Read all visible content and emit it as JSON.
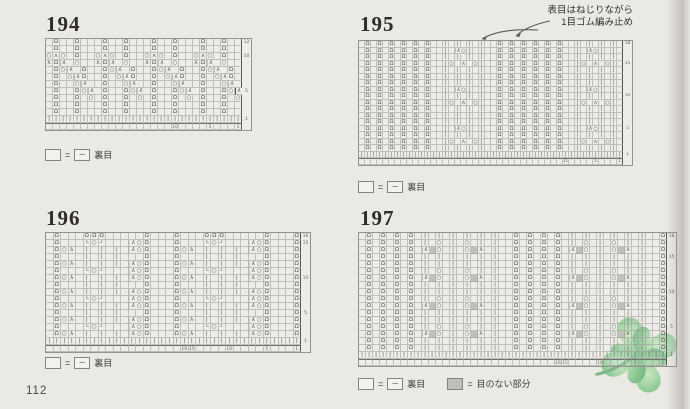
{
  "page": {
    "number": "112"
  },
  "colors": {
    "page_bg": "#ebe9e4",
    "grid_line": "#95938e",
    "symbol_color": "#524f4b",
    "no_stitch_fill": "#c2c0ba",
    "clover_green": "#7cbd88"
  },
  "legend": {
    "eq": "=",
    "purl_dash": "─",
    "purl_label": "裏目",
    "no_stitch_label": "目のない部分"
  },
  "annotation195": {
    "line1": "表目はねじりながら",
    "line2": "1目ゴム編み止め"
  },
  "glyph_map": {
    ".": "",
    "Q": "Ω",
    "o": "○",
    "A": "λ",
    "L": "λ",
    "Y": "ʌ",
    "|": "|",
    "#": "",
    "(": "└",
    ")": "┘"
  },
  "charts": [
    {
      "id": "194",
      "title": "194",
      "x": 45,
      "y": 38,
      "cols": 28,
      "cell_w": 7,
      "cell_h": 7,
      "font": 5.5,
      "title_x": 46,
      "title_y": 12,
      "rows": [
        ".Q..Q...Q..Q...Q..Q...Q..Q..",
        ".Q..Q...Q..Q...Q..Q...Q..Q..",
        "oYo.Q..oYo.Q..oYo.Q..oYo.Q..",
        "LQA.o..LQA.o..LQA.o..LQA.o..",
        ".QoA.Q..QoA.Q..QoA.Q..QoA.Q.",
        ".Q.oAQ..Q.oAQ..Q.oAQ..Q.oAQ.",
        ".Q..oA..Q..oA..Q..oA..Q..oA.",
        ".Q..QoA.Q..QoA.Q..QoA.Q..QoA",
        ".Q..Q.o.Q..Q.o.Q..Q.o.Q..Q.o",
        ".Q..Q...Q..Q...Q..Q...Q..Q..",
        ".Q..Q...Q..Q...Q..Q...Q..Q.."
      ],
      "row_marks": [
        "1",
        "5",
        "10",
        "12"
      ],
      "col_marks": [
        "1",
        "5",
        "10"
      ]
    },
    {
      "id": "195",
      "title": "195",
      "x": 358,
      "y": 40,
      "cols": 44,
      "cell_w": 6,
      "cell_h": 6.5,
      "font": 5,
      "title_x": 360,
      "title_y": 12,
      "rows": [
        ".Q.Q.Q.Q.Q.Q..|.|.|.|..Q.Q.Q.Q.Q.Q..|.|.|.|.",
        ".Q.Q.Q.Q.Q.Q..|.Ao|.|..Q.Q.Q.Q.Q.Q..|.Ao|.|.",
        ".Q.Q.Q.Q.Q.Q..|.|.|.|..Q.Q.Q.Q.Q.Q..|.|.|.|.",
        ".Q.Q.Q.Q.Q.Q..|o.Y.o|..Q.Q.Q.Q.Q.Q..|o.Y.o|.",
        ".Q.Q.Q.Q.Q.Q..|.|.|.|..Q.Q.Q.Q.Q.Q..|.|.|.|.",
        ".Q.Q.Q.Q.Q.Q..|.|.|.|..Q.Q.Q.Q.Q.Q..|.|.|.|.",
        ".Q.Q.Q.Q.Q.Q..|.|.|.|..Q.Q.Q.Q.Q.Q..|.|.|.|.",
        ".Q.Q.Q.Q.Q.Q..|.Ao|.|..Q.Q.Q.Q.Q.Q..|.Ao|.|.",
        ".Q.Q.Q.Q.Q.Q..|.|.|.|..Q.Q.Q.Q.Q.Q..|.|.|.|.",
        ".Q.Q.Q.Q.Q.Q..|o.Y.o|..Q.Q.Q.Q.Q.Q..|o.Y.o|.",
        ".Q.Q.Q.Q.Q.Q..|.|.|.|..Q.Q.Q.Q.Q.Q..|.|.|.|.",
        ".Q.Q.Q.Q.Q.Q..|.|.|.|..Q.Q.Q.Q.Q.Q..|.|.|.|.",
        ".Q.Q.Q.Q.Q.Q..|.|.|.|..Q.Q.Q.Q.Q.Q..|.|.|.|.",
        ".Q.Q.Q.Q.Q.Q..|.Ao|.|..Q.Q.Q.Q.Q.Q..|.Ao|.|.",
        ".Q.Q.Q.Q.Q.Q..|.|.|.|..Q.Q.Q.Q.Q.Q..|.|.|.|.",
        ".Q.Q.Q.Q.Q.Q..|o.Y.o|..Q.Q.Q.Q.Q.Q..|o.Y.o|.",
        ".Q.Q.Q.Q.Q.Q..|.|.|.|..Q.Q.Q.Q.Q.Q..|.|.|.|."
      ],
      "row_marks": [
        "1",
        "5",
        "10",
        "15",
        "18"
      ],
      "col_marks": [
        "1",
        "5",
        "10"
      ]
    },
    {
      "id": "196",
      "title": "196",
      "x": 45,
      "y": 232,
      "cols": 34,
      "cell_w": 7.5,
      "cell_h": 7,
      "font": 5.5,
      "title_x": 46,
      "title_y": 206,
      "rows": [
        ".Q...QQQ.....Q...Q...QQQ.....Q...Q",
        ".Q...(o)...AoQ...Q...(o)...AoQ...Q",
        ".QoL.|.|.|.AoQ...QoL.|.|.|.AoQ...Q",
        ".Q...|.|.|...Q...Q...|.|.|...Q...Q",
        ".QoL.|.|.|.AoQ...QoL.|.|.|.AoQ...Q",
        ".Q...(o)...AoQ...Q...(o)...AoQ...Q",
        ".QoL.|.|.|.AoQ...QoL.|.|.|.AoQ...Q",
        ".Q...|.|.|...Q...Q...|.|.|...Q...Q",
        ".QoL.|.|.|.AoQ...QoL.|.|.|.AoQ...Q",
        ".Q...(o)...AoQ...Q...(o)...AoQ...Q",
        ".QoL.|.|.|.AoQ...QoL.|.|.|.AoQ...Q",
        ".Q...|.|.|...Q...Q...|.|.|...Q...Q",
        ".QoL.|.|.|.AoQ...QoL.|.|.|.AoQ...Q",
        ".Q...(o)...AoQ...Q...(o)...AoQ...Q",
        ".QoL.|.|.|.AoQ...QoL.|.|.|.AoQ...Q"
      ],
      "row_marks": [
        "1",
        "5",
        "10",
        "15",
        "16"
      ],
      "col_marks": [
        "1",
        "5",
        "10",
        "15",
        "16"
      ]
    },
    {
      "id": "197",
      "title": "197",
      "x": 358,
      "y": 232,
      "cols": 44,
      "cell_w": 7,
      "cell_h": 7,
      "font": 5.5,
      "title_x": 360,
      "title_y": 206,
      "rows": [
        ".Q.Q.Q.Q.|.|.|.|.|.|..Q.Q.Q.Q.|.|.|.|.|.|..Q",
        ".Q.Q.Q.Q.|.o.|.o.|.|..Q.Q.Q.Q.|.o.|.o.|.|..Q",
        ".Q.Q.Q.Q.A#o.|.o#L.|..Q.Q.Q.Q.A#o.|.o#L.|..Q",
        ".Q.Q.Q.Q.|.|.|.|.|.|..Q.Q.Q.Q.|.|.|.|.|.|..Q",
        ".Q.Q.Q.Q.|.|.|.|.|.|..Q.Q.Q.Q.|.|.|.|.|.|..Q",
        ".Q.Q.Q.Q.|.o.|.o.|.|..Q.Q.Q.Q.|.o.|.o.|.|..Q",
        ".Q.Q.Q.Q.A#o.|.o#L.|..Q.Q.Q.Q.A#o.|.o#L.|..Q",
        ".Q.Q.Q.Q.|.|.|.|.|.|..Q.Q.Q.Q.|.|.|.|.|.|..Q",
        ".Q.Q.Q.Q.|.|.|.|.|.|..Q.Q.Q.Q.|.|.|.|.|.|..Q",
        ".Q.Q.Q.Q.|.o.|.o.|.|..Q.Q.Q.Q.|.o.|.o.|.|..Q",
        ".Q.Q.Q.Q.A#o.|.o#L.|..Q.Q.Q.Q.A#o.|.o#L.|..Q",
        ".Q.Q.Q.Q.|.|.|.|.|.|..Q.Q.Q.Q.|.|.|.|.|.|..Q",
        ".Q.Q.Q.Q.|.|.|.|.|.|..Q.Q.Q.Q.|.|.|.|.|.|..Q",
        ".Q.Q.Q.Q.|.o.|.o.|.|..Q.Q.Q.Q.|.o.|.o.|.|..Q",
        ".Q.Q.Q.Q.A#o.|.o#L.|..Q.Q.Q.Q.A#o.|.o#L.|..Q",
        ".Q.Q.Q.Q.|.|.|.|.|.|..Q.Q.Q.Q.|.|.|.|.|.|..Q",
        ".Q.Q.Q.Q.|.|.|.|.|.|..Q.Q.Q.Q.|.|.|.|.|.|..Q"
      ],
      "row_marks": [
        "1",
        "5",
        "10",
        "15",
        "18"
      ],
      "col_marks": [
        "1",
        "5",
        "10",
        "15",
        "16"
      ]
    }
  ]
}
